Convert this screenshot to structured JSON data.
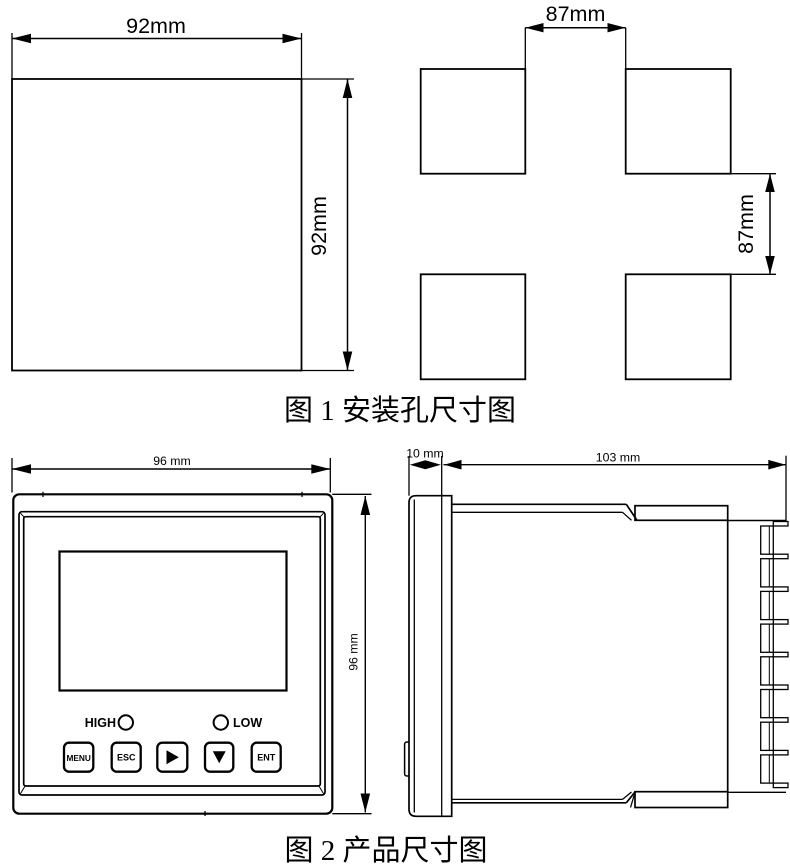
{
  "figure1": {
    "caption": "图 1 安装孔尺寸图",
    "left_square": {
      "width_label": "92mm",
      "height_label": "92mm"
    },
    "cutout": {
      "width_label": "87mm",
      "height_label": "87mm"
    }
  },
  "figure2": {
    "caption": "图 2 产品尺寸图",
    "front_view": {
      "width_label": "96 mm",
      "height_label": "96 mm",
      "indicators": [
        {
          "label": "HIGH"
        },
        {
          "label": "LOW"
        }
      ],
      "buttons": [
        {
          "label": "MENU"
        },
        {
          "label": "ESC"
        },
        {
          "icon": "right-triangle-icon"
        },
        {
          "icon": "down-triangle-icon"
        },
        {
          "label": "ENT"
        }
      ]
    },
    "side_view": {
      "bezel_depth_label": "10 mm",
      "body_depth_label": "103 mm"
    }
  },
  "colors": {
    "line": "#000000",
    "background": "#ffffff"
  }
}
